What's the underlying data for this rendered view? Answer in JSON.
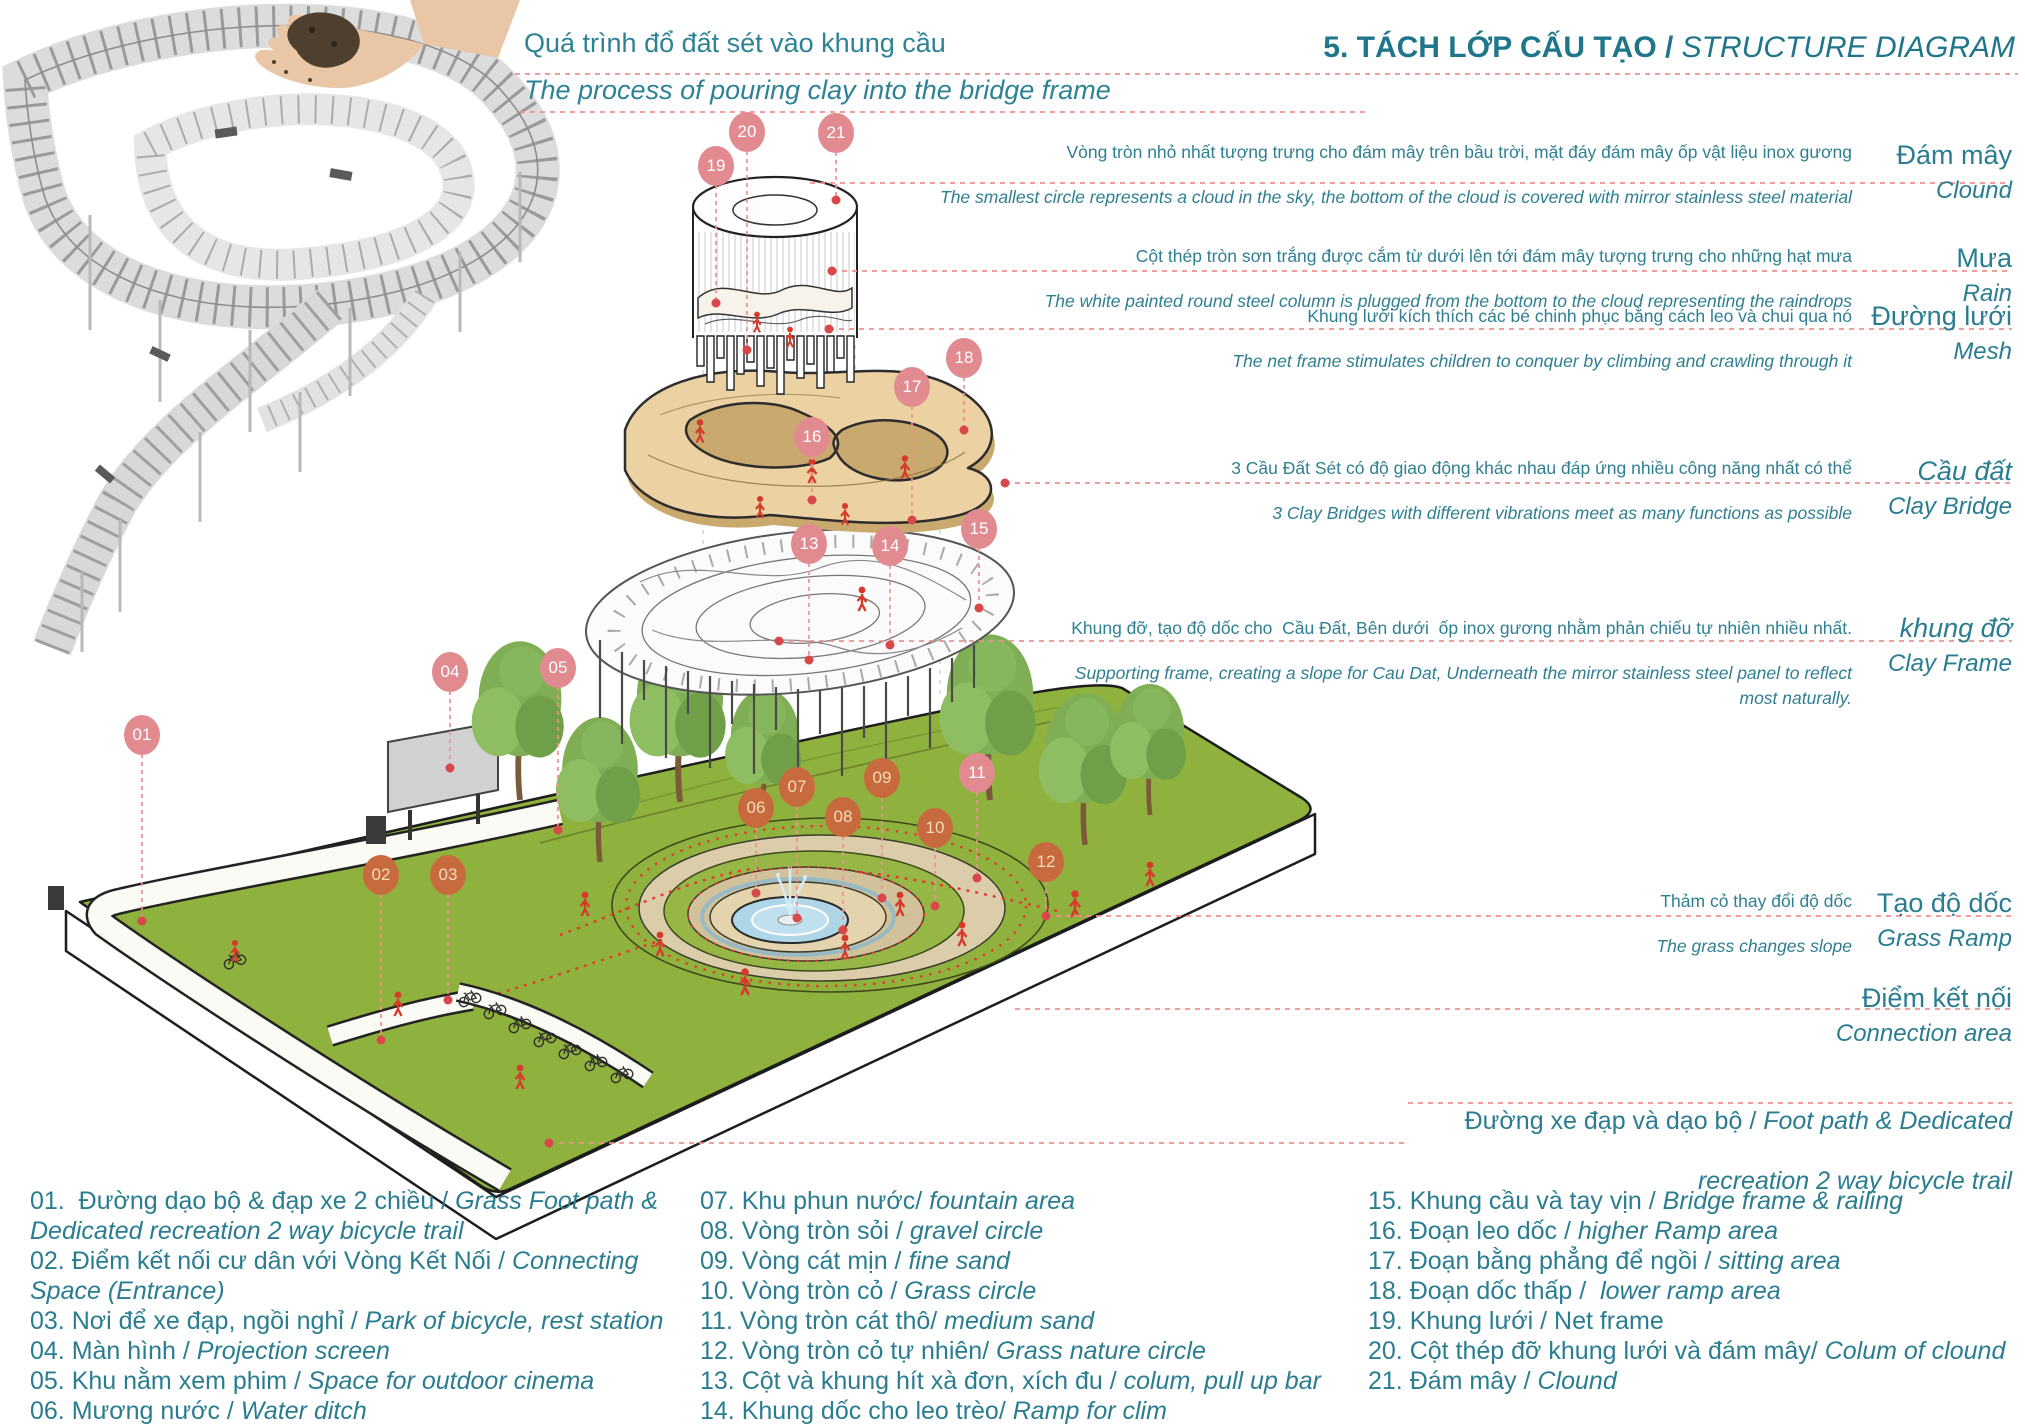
{
  "title": {
    "vn_bold": "5. TÁCH LỚP CẤU TẠO / ",
    "en_italic": "STRUCTURE DIAGRAM"
  },
  "hand_caption": {
    "vn": "Quá trình đổ đất sét vào khung cầu",
    "en": "The process of pouring clay into the bridge frame"
  },
  "colors": {
    "teal_text": "#2a7d91",
    "title_teal": "#1f7589",
    "salmon_balloon": "#e18b90",
    "orange_balloon": "#c76b3e",
    "dashed_leader": "#ef9090",
    "field_green": "#8fb23e",
    "clay_tan": "#ecd2a3",
    "pool_blue": "#aed6e6",
    "red_dot": "#d84848"
  },
  "annotations": [
    {
      "id": "cloud",
      "vn": "Vòng tròn nhỏ nhất tượng trưng cho đám mây trên bầu trời, mặt đáy đám mây ốp vật liệu inox gương",
      "en": "The smallest circle represents a cloud in the sky, the bottom of the cloud is covered with mirror stainless steel material",
      "label_vn": "Đám mây",
      "label_en": "Clound",
      "italic_label": false
    },
    {
      "id": "rain",
      "vn": "Cột thép tròn sơn trắng được cắm từ dưới lên tới đám mây tượng trưng cho những hạt mưa",
      "en": "The white painted round steel column is plugged from the bottom to the cloud representing the raindrops",
      "label_vn": "Mưa",
      "label_en": "Rain",
      "italic_label": false
    },
    {
      "id": "mesh",
      "vn": "Khung lưới kích thích các bé chinh phục bằng cách leo và chui qua nó",
      "en": "The net frame stimulates children to conquer by climbing and crawling through it",
      "label_vn": "Đường lưới",
      "label_en": "Mesh",
      "italic_label": false
    },
    {
      "id": "clay-bridge",
      "vn": "3 Cầu Đất Sét có độ giao động khác nhau đáp ứng nhiều công năng nhất có thể",
      "en": "3 Clay Bridges with different vibrations meet as many functions as possible",
      "label_vn": "Cầu đất",
      "label_en": "Clay Bridge",
      "italic_label": true
    },
    {
      "id": "clay-frame",
      "vn": "Khung đỡ, tạo độ dốc cho  Cầu Đất, Bên dưới  ốp inox gương nhằm phản chiếu tự nhiên nhiều nhất.",
      "en": "Supporting frame, creating a slope for Cau Dat, Underneath the mirror stainless steel panel to reflect",
      "en2": "most naturally.",
      "label_vn": "khung đỡ",
      "label_en": "Clay Frame",
      "italic_label": true
    },
    {
      "id": "grass-ramp",
      "vn": "Thảm cỏ thay đổi độ dốc",
      "en": "The grass changes slope",
      "label_vn": "Tạo độ dốc",
      "label_en": "Grass Ramp",
      "italic_label": false
    },
    {
      "id": "connection",
      "vn": "",
      "en": "",
      "label_vn": "Điểm kết nối",
      "label_en": "Connection area",
      "italic_label": false
    }
  ],
  "footpath_label": {
    "line1_vn": "Đường xe đạp và dạo bộ / ",
    "line1_en": "Foot path & Dedicated",
    "line2": "recreation 2 way bicycle trail"
  },
  "balloons": [
    {
      "n": "01",
      "x": 142,
      "y": 735,
      "ey": 921,
      "variant": "s"
    },
    {
      "n": "02",
      "x": 381,
      "y": 875,
      "ey": 1040,
      "variant": "o"
    },
    {
      "n": "03",
      "x": 448,
      "y": 875,
      "ey": 1000,
      "variant": "o"
    },
    {
      "n": "04",
      "x": 450,
      "y": 672,
      "ey": 768,
      "variant": "s"
    },
    {
      "n": "05",
      "x": 558,
      "y": 668,
      "ey": 830,
      "variant": "s"
    },
    {
      "n": "06",
      "x": 756,
      "y": 808,
      "ey": 893,
      "variant": "o"
    },
    {
      "n": "07",
      "x": 797,
      "y": 787,
      "ey": 918,
      "variant": "o"
    },
    {
      "n": "08",
      "x": 843,
      "y": 817,
      "ey": 930,
      "variant": "o"
    },
    {
      "n": "09",
      "x": 882,
      "y": 778,
      "ey": 898,
      "variant": "o"
    },
    {
      "n": "10",
      "x": 935,
      "y": 828,
      "ey": 906,
      "variant": "o"
    },
    {
      "n": "11",
      "x": 977,
      "y": 773,
      "ey": 878,
      "variant": "s"
    },
    {
      "n": "12",
      "x": 1046,
      "y": 862,
      "ey": 916,
      "variant": "o"
    },
    {
      "n": "13",
      "x": 809,
      "y": 544,
      "ey": 660,
      "variant": "s"
    },
    {
      "n": "14",
      "x": 890,
      "y": 546,
      "ey": 645,
      "variant": "s"
    },
    {
      "n": "15",
      "x": 979,
      "y": 529,
      "ey": 608,
      "variant": "s"
    },
    {
      "n": "16",
      "x": 812,
      "y": 437,
      "ey": 500,
      "variant": "s"
    },
    {
      "n": "17",
      "x": 912,
      "y": 387,
      "ey": 520,
      "variant": "s"
    },
    {
      "n": "18",
      "x": 964,
      "y": 358,
      "ey": 430,
      "variant": "s"
    },
    {
      "n": "19",
      "x": 716,
      "y": 166,
      "ey": 303,
      "variant": "s"
    },
    {
      "n": "20",
      "x": 747,
      "y": 132,
      "ey": 350,
      "variant": "s"
    },
    {
      "n": "21",
      "x": 836,
      "y": 133,
      "ey": 200,
      "variant": "s"
    }
  ],
  "legend": {
    "columns": [
      [
        {
          "vn": "01.  Đường dạo bộ & đạp xe 2 chiều / ",
          "en": "Grass Foot path & Dedicated recreation 2 way bicycle trail"
        },
        {
          "vn": "02. Điểm kết nối cư dân với Vòng Kết Nối / ",
          "en": "Connecting Space (Entrance)"
        },
        {
          "vn": "03. Nơi để xe đạp, ngồi nghỉ / ",
          "en": "Park of bicycle, rest station"
        },
        {
          "vn": "04. Màn hình / ",
          "en": "Projection screen"
        },
        {
          "vn": "05. Khu nằm xem phim / ",
          "en": "Space for outdoor cinema"
        },
        {
          "vn": "06. Mương nước / ",
          "en": "Water ditch"
        }
      ],
      [
        {
          "vn": "07. Khu phun nước/ ",
          "en": "fountain area"
        },
        {
          "vn": "08. Vòng tròn sỏi / ",
          "en": "gravel circle"
        },
        {
          "vn": "09. Vòng cát mịn / ",
          "en": "fine sand"
        },
        {
          "vn": "10. Vòng tròn cỏ / ",
          "en": "Grass circle"
        },
        {
          "vn": "11. Vòng tròn cát thô/ ",
          "en": "medium sand"
        },
        {
          "vn": "12. Vòng tròn cỏ tự nhiên/ ",
          "en": "Grass nature circle"
        },
        {
          "vn": "13. Cột và khung hít xà đơn, xích đu / ",
          "en": "colum, pull up bar"
        },
        {
          "vn": "14. Khung dốc cho leo trèo/ ",
          "en": "Ramp for clim"
        }
      ],
      [
        {
          "vn": "15. Khung cầu và tay vịn / ",
          "en": "Bridge frame & railing"
        },
        {
          "vn": "16. Đoạn leo dốc / ",
          "en": "higher Ramp area"
        },
        {
          "vn": "17. Đoạn bằng phẳng để ngồi / ",
          "en": "sitting area"
        },
        {
          "vn": "18. Đoạn dốc thấp /  ",
          "en": "lower ramp area"
        },
        {
          "vn": "19. Khung lưới / Net frame",
          "en": ""
        },
        {
          "vn": "20. Cột thép đỡ khung lưới và đám mây/ ",
          "en": "Colum of clound"
        },
        {
          "vn": "21. Đám mây / ",
          "en": "Clound"
        }
      ]
    ]
  }
}
